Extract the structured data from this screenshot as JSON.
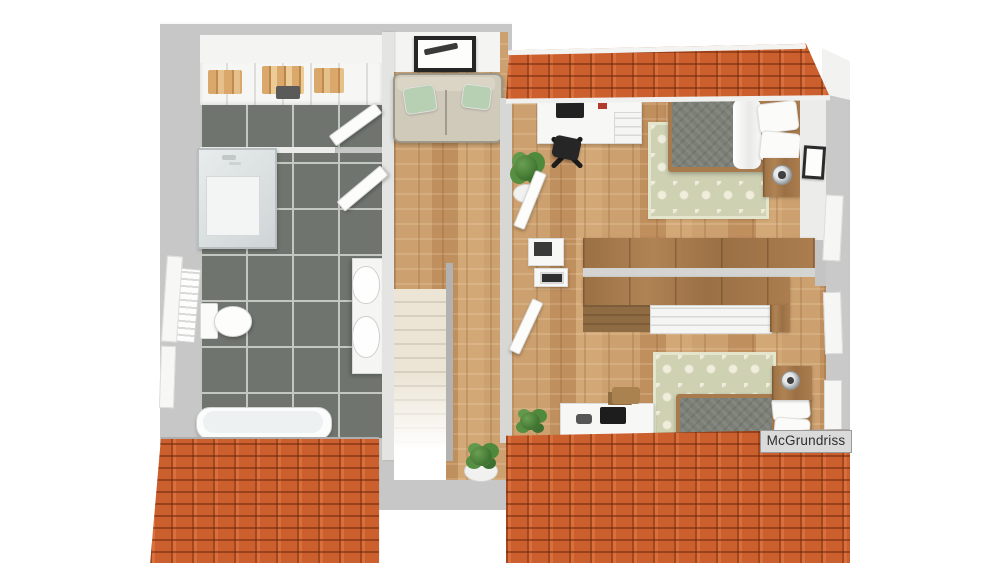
{
  "watermark": {
    "label": "McGrundriss"
  },
  "colors": {
    "wall": "#c6c7c6",
    "wallinner": "#dededd",
    "tile": "#70746e",
    "grout": "#c3c7c1",
    "wood": "#cda16f",
    "roof": "#cc5f2e",
    "rug": "#ced1b2",
    "rugdot": "#f1eddd",
    "sofa": "#d0cabb",
    "pillowgreen": "#b7cfb2",
    "mattress": "#7c7f76",
    "stair": "#ece5d6"
  },
  "icons": {
    "watermark-badge": "vendor watermark label",
    "picture-frame-icon": "framed artwork",
    "plant-icon": "potted plant",
    "lamp-icon": "bedside lamp"
  }
}
